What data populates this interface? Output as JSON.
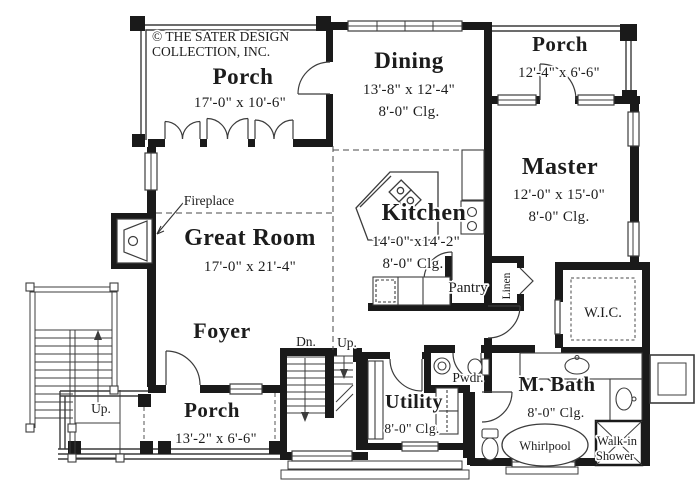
{
  "branding": {
    "copyright_line1": "© THE SATER DESIGN",
    "copyright_line2": "COLLECTION, INC."
  },
  "rooms": {
    "porch_upper_left": {
      "name": "Porch",
      "dims": "17'-0\" x 10'-6\""
    },
    "dining": {
      "name": "Dining",
      "dims": "13'-8\" x 12'-4\"",
      "ceiling": "8'-0\" Clg."
    },
    "porch_upper_right": {
      "name": "Porch",
      "dims": "12'-4\" x 6'-6\""
    },
    "master": {
      "name": "Master",
      "dims": "12'-0\" x 15'-0\"",
      "ceiling": "8'-0\" Clg."
    },
    "kitchen": {
      "name": "Kitchen",
      "dims": "14'-0\" x14'-2\"",
      "ceiling": "8'-0\" Clg."
    },
    "great_room": {
      "name": "Great Room",
      "dims": "17'-0\" x 21'-4\""
    },
    "foyer": {
      "name": "Foyer"
    },
    "porch_lower": {
      "name": "Porch",
      "dims": "13'-2\" x 6'-6\""
    },
    "utility": {
      "name": "Utility",
      "ceiling": "8'-0\" Clg."
    },
    "powder": {
      "name": "Pwdr."
    },
    "master_bath": {
      "name": "M. Bath",
      "ceiling": "8'-0\" Clg."
    },
    "wic": {
      "name": "W.I.C."
    },
    "pantry": {
      "name": "Pantry"
    },
    "linen": {
      "name": "Linen"
    }
  },
  "fixtures": {
    "fireplace": "Fireplace",
    "whirlpool": "Whirlpool",
    "walk_in_shower_line1": "Walk-in",
    "walk_in_shower_line2": "Shower"
  },
  "stairs": {
    "down_abbrev": "Dn.",
    "up_abbrev": "Up.",
    "up_exterior": "Up."
  },
  "colors": {
    "walls": "#1a1a1a",
    "thin_lines": "#3c3c3c",
    "background": "#ffffff",
    "text": "#1c1c1c"
  }
}
